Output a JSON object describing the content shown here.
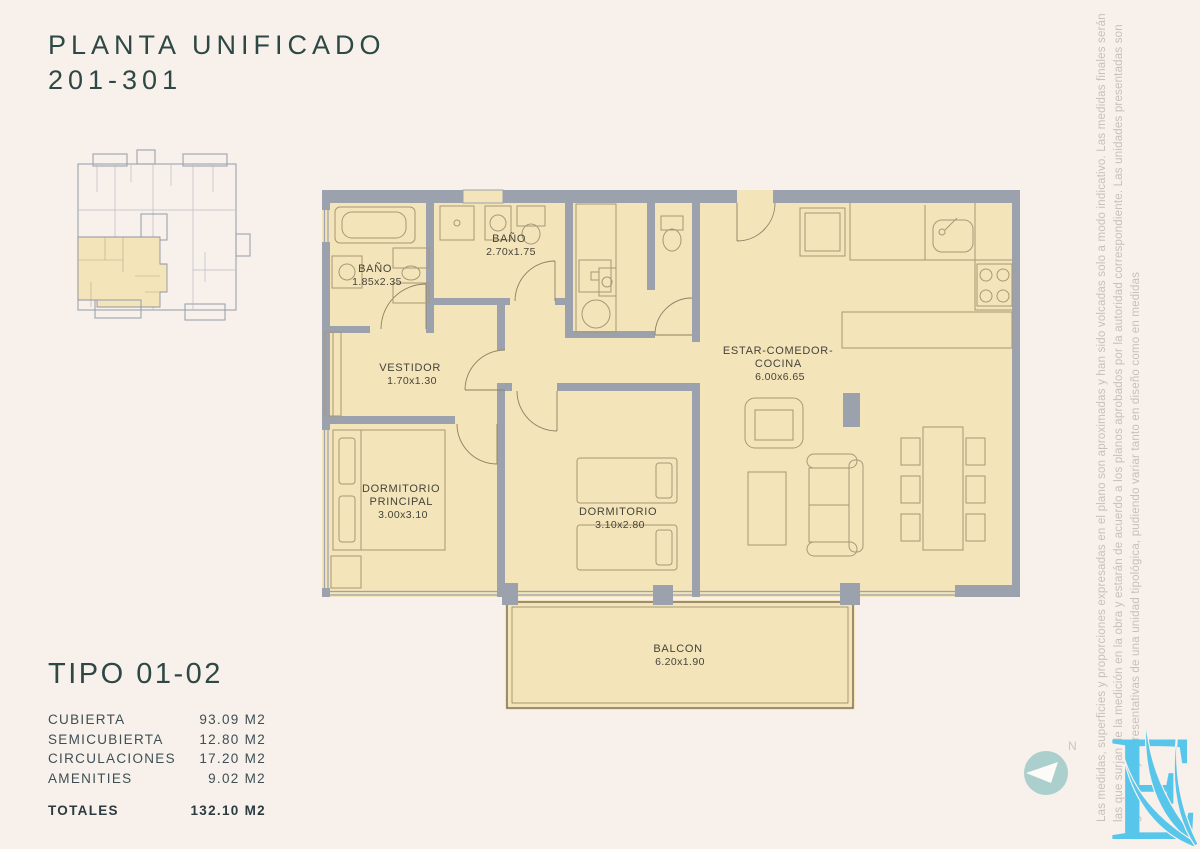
{
  "title": {
    "line1": "PLANTA UNIFICADO",
    "line2": "201-301"
  },
  "unit_summary": {
    "heading": "TIPO 01-02",
    "rows": [
      {
        "label": "CUBIERTA",
        "value": "93.09 M2"
      },
      {
        "label": "SEMICUBIERTA",
        "value": "12.80 M2"
      },
      {
        "label": "CIRCULACIONES",
        "value": "17.20 M2"
      },
      {
        "label": "AMENITIES",
        "value": "9.02 M2"
      }
    ],
    "total_label": "TOTALES",
    "total_value": "132.10 M2"
  },
  "floor_plan": {
    "rooms": {
      "bano_1": {
        "name": "BAÑO",
        "dims": "1.85x2.35"
      },
      "bano_2": {
        "name": "BAÑO",
        "dims": "2.70x1.75"
      },
      "vestidor": {
        "name": "VESTIDOR",
        "dims": "1.70x1.30"
      },
      "dormitorio_principal": {
        "name_line1": "DORMITORIO",
        "name_line2": "PRINCIPAL",
        "dims": "3.00x3.10"
      },
      "dormitorio": {
        "name": "DORMITORIO",
        "dims": "3.10x2.80"
      },
      "estar_comedor_cocina": {
        "name_line1": "ESTAR-COMEDOR-",
        "name_line2": "COCINA",
        "dims": "6.00x6.65"
      },
      "balcon": {
        "name": "BALCON",
        "dims": "6.20x1.90"
      }
    }
  },
  "compass": {
    "north_label": "N"
  },
  "disclaimer": {
    "line1": "Las medidas, superficies y proporciones expresadas en el plano son aproximadas y han sido volcadas solo a modo indicativo. Las medidas finales serán",
    "line2": "las que surjan de la medición en la obra y estarán de acuerdo a los planos aprobados por la autoridad correspondiente. Las unidades presentadas son",
    "line3": "genéricas y representativas de una unidad tipológica, pudiendo variar tanto en diseño como en medidas"
  },
  "colors": {
    "background": "#f8f1eb",
    "room_fill": "#f3e4ba",
    "wall_gray": "#9ba2ad",
    "accent_teal": "#2d4845",
    "logo_blue": "#58c6ea",
    "compass_teal": "#abcfcc"
  }
}
